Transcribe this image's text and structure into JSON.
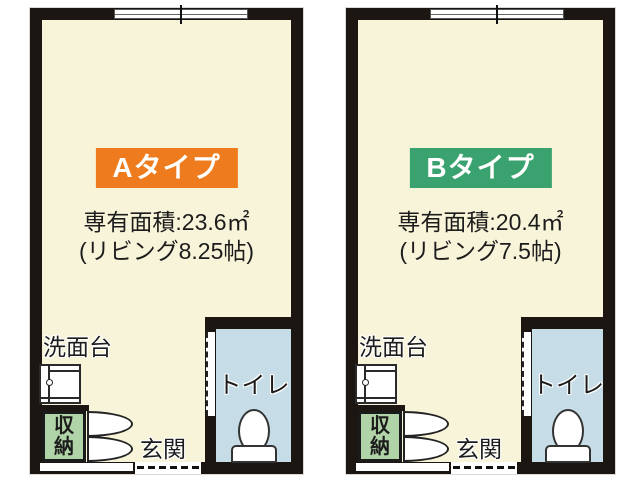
{
  "colors": {
    "background": "#ffffff",
    "wall": "#1c1613",
    "floor": "#f8f4d9",
    "toilet_floor": "#c6dde7",
    "storage_fill": "#b0d4a7",
    "type_a_fill": "#ee7c1e",
    "type_b_fill": "#3aa26e",
    "type_text": "#ffffff",
    "text": "#1c1c1c"
  },
  "plans": [
    {
      "type_label": "Aタイプ",
      "area_text": "専有面積:23.6㎡",
      "living_text": "(リビング8.25帖)",
      "washbasin_label": "洗面台",
      "storage_char_top": "収",
      "storage_char_bottom": "納",
      "entrance_label": "玄関",
      "toilet_label": "トイレ"
    },
    {
      "type_label": "Bタイプ",
      "area_text": "専有面積:20.4㎡",
      "living_text": "(リビング7.5帖)",
      "washbasin_label": "洗面台",
      "storage_char_top": "収",
      "storage_char_bottom": "納",
      "entrance_label": "玄関",
      "toilet_label": "トイレ"
    }
  ]
}
